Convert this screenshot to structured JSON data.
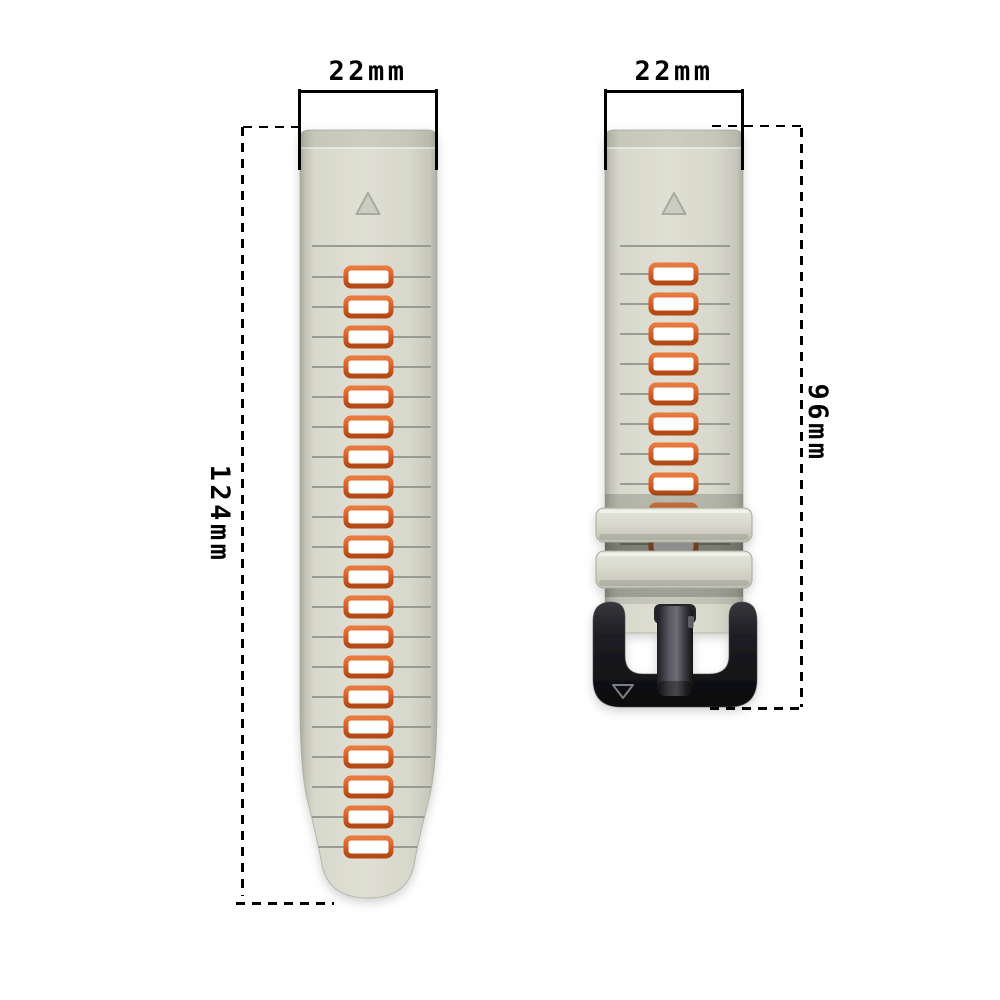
{
  "title": "Silicone watch band size diagram",
  "dimensions": {
    "left_strap_width_label": "22mm",
    "right_strap_width_label": "22mm",
    "left_strap_length_label": "124mm",
    "right_strap_length_label": "96mm"
  },
  "left_strap": {
    "slot_count": 20,
    "groove_count": 21,
    "marker": "triangle-up",
    "shape": "long tapered band with rounded tip"
  },
  "right_strap": {
    "slot_count": 10,
    "visible_full_slots": 8,
    "keeper_count": 2,
    "marker": "triangle-up",
    "buckle": "black pin buckle",
    "buckle_logo": "triangle-down-outline"
  },
  "icons": {
    "strap_marker": "triangle-up-icon",
    "buckle_logo": "delta-outline-icon"
  },
  "colors": {
    "background": "#ffffff",
    "strap_base": "#d9dacd",
    "strap_edge": "#aeafa3",
    "groove": "#8f9086",
    "slot_fill": "#ffffff",
    "slot_border": "#d45c22",
    "keeper": "#d9dacd",
    "buckle_black": "#17171a",
    "annotation": "#000000"
  }
}
